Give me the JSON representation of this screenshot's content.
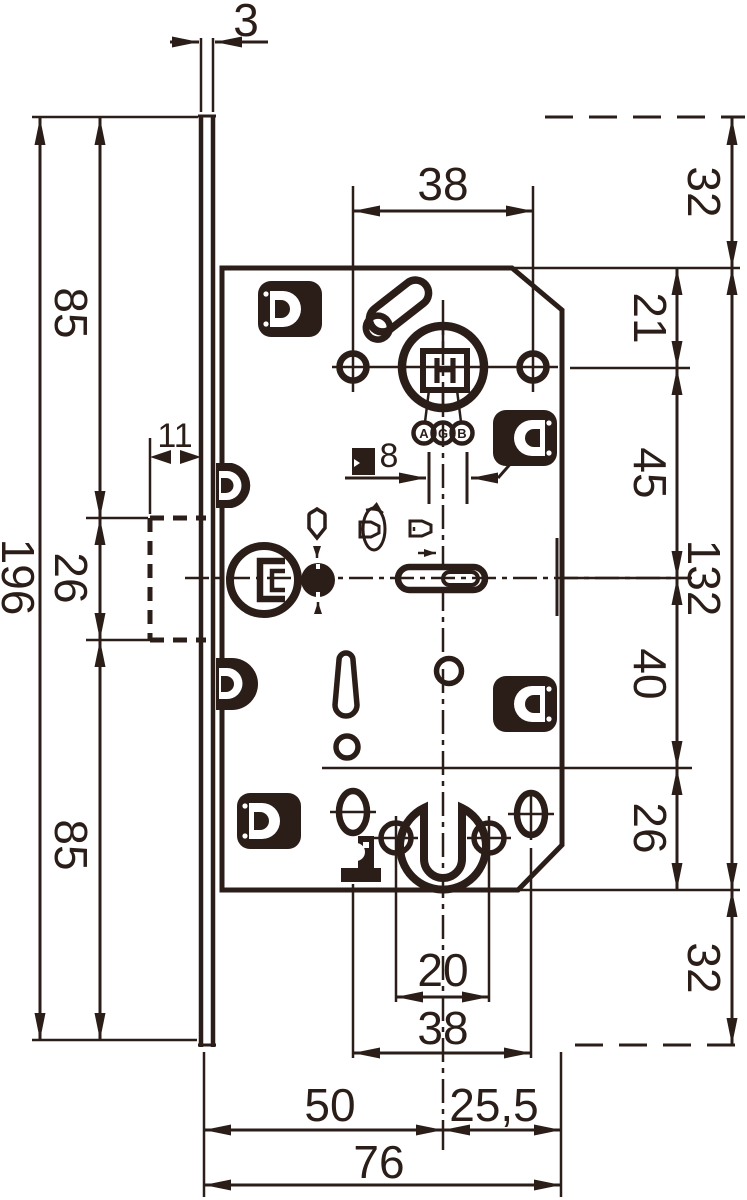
{
  "brand": {
    "logo_letters": [
      "A",
      "G",
      "B"
    ],
    "hub_marking": "H"
  },
  "dimensions": {
    "plate_thickness": "3",
    "plate_length": "196",
    "plate_top_segment": "85",
    "strike_opening": "26",
    "plate_bottom_segment": "85",
    "strike_depth": "11",
    "hub_screws_spacing": "38",
    "spindle_square": "8",
    "top_margin": "32",
    "top_edge_to_hub": "21",
    "hub_to_latch": "45",
    "case_height": "132",
    "latch_to_cylinder": "40",
    "cylinder_to_bottom_edge": "26",
    "bottom_margin": "32",
    "cylinder_screws_spacing": "20",
    "bottom_holes_spacing": "38",
    "backset": "50",
    "centre_to_back": "25,5",
    "case_depth": "76"
  },
  "icons": {
    "hub_square": "spindle-square-icon",
    "privacy": "shield-icon",
    "key_turn": "key-turn-icon",
    "key_insert": "key-insert-icon",
    "fixing_lug": "fixing-lug-icon"
  }
}
